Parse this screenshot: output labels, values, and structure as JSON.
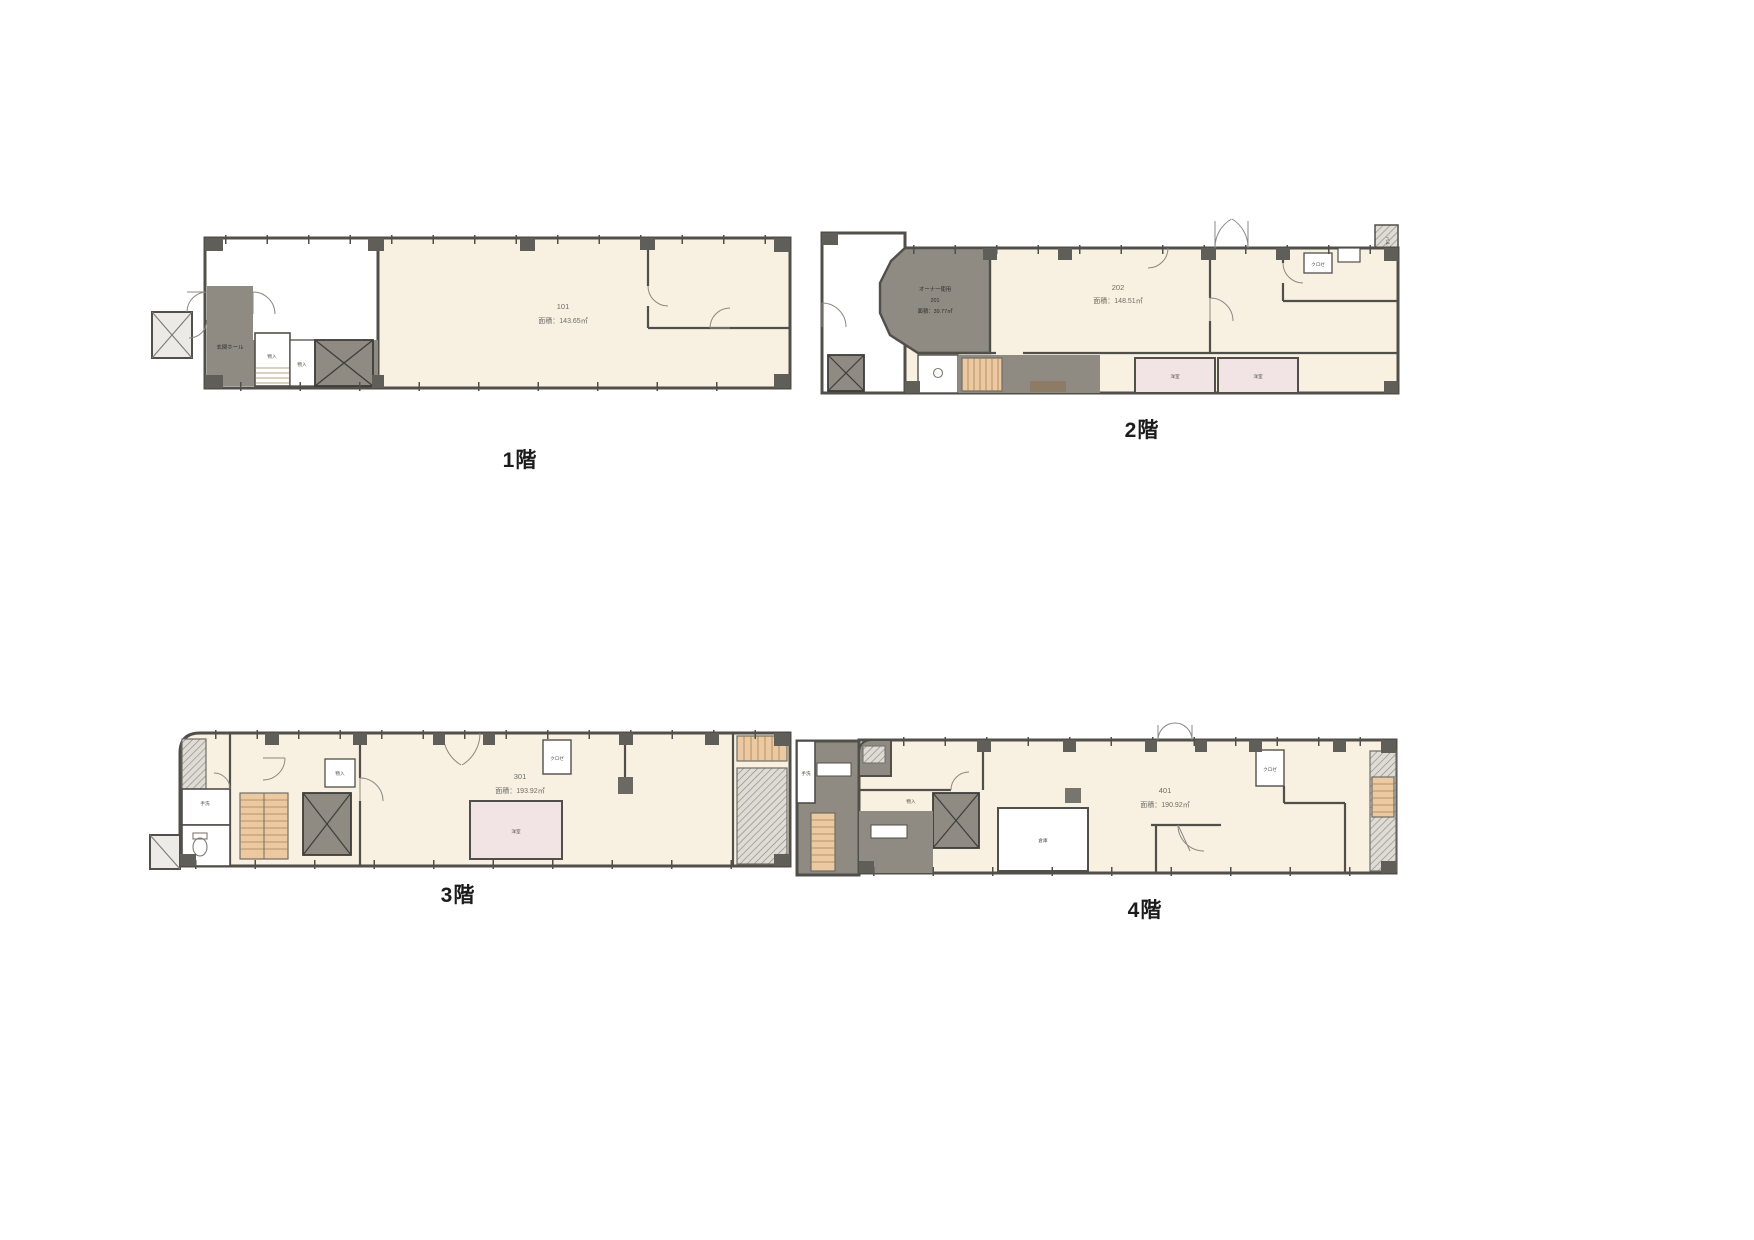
{
  "page": {
    "background": "#ffffff"
  },
  "floors": {
    "f1": {
      "title": "1階",
      "room": {
        "number": "101",
        "area": "面積：143.65㎡"
      },
      "labels": {
        "hall": "玄関ホール",
        "storage1": "物入",
        "storage2": "物入"
      }
    },
    "f2": {
      "title": "2階",
      "owner": {
        "use": "オーナー使用",
        "number": "201",
        "area": "面積：39.77㎡"
      },
      "room": {
        "number": "202",
        "area": "面積：148.51㎡"
      },
      "labels": {
        "closet": "クロゼ",
        "balcony": "バルコニー",
        "western1": "洋室",
        "western2": "洋室"
      }
    },
    "f3": {
      "title": "3階",
      "room": {
        "number": "301",
        "area": "面積：193.92㎡"
      },
      "labels": {
        "closet": "クロゼ",
        "washstand": "手洗",
        "storage": "物入",
        "western": "洋室"
      }
    },
    "f4": {
      "title": "4階",
      "room": {
        "number": "401",
        "area": "面積：190.92㎡"
      },
      "labels": {
        "closet": "クロゼ",
        "storage": "物入",
        "storeroom": "倉庫",
        "washstand": "手洗"
      }
    }
  }
}
